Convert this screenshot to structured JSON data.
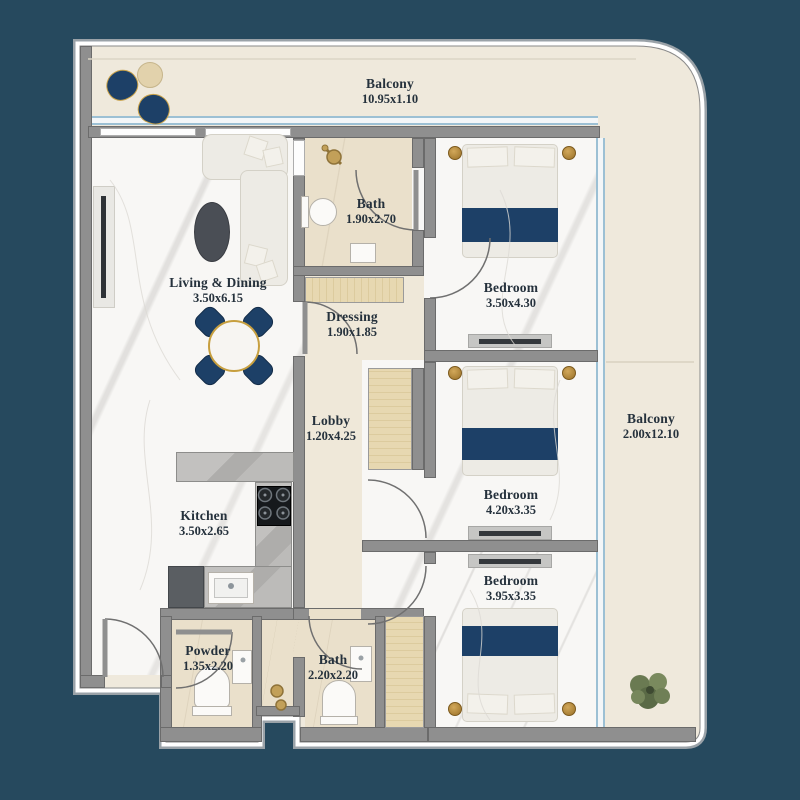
{
  "plan": {
    "title": "Apartment Floor Plan",
    "rooms": [
      {
        "name": "Balcony",
        "dims": "10.95x1.10"
      },
      {
        "name": "Living & Dining",
        "dims": "3.50x6.15"
      },
      {
        "name": "Bath",
        "dims": "1.90x2.70"
      },
      {
        "name": "Bedroom",
        "dims": "3.50x4.30"
      },
      {
        "name": "Dressing",
        "dims": "1.90x1.85"
      },
      {
        "name": "Lobby",
        "dims": "1.20x4.25"
      },
      {
        "name": "Balcony",
        "dims": "2.00x12.10"
      },
      {
        "name": "Bedroom",
        "dims": "4.20x3.35"
      },
      {
        "name": "Kitchen",
        "dims": "3.50x2.65"
      },
      {
        "name": "Bedroom",
        "dims": "3.95x3.35"
      },
      {
        "name": "Powder",
        "dims": "1.35x2.20"
      },
      {
        "name": "Bath",
        "dims": "2.20x2.20"
      }
    ],
    "icons": {
      "bed-icon": "double bed with navy runner",
      "sofa-icon": "L-shaped sofa",
      "dining-table-icon": "round table with 4 navy chairs",
      "coffee-table-icon": "dark oval table",
      "tv-icon": "wall-mounted TV panel",
      "stove-icon": "4-burner hob",
      "sink-icon": "kitchen sink",
      "fridge-icon": "refrigerator",
      "toilet-icon": "WC",
      "basin-icon": "wash basin",
      "shower-icon": "gold shower mixer",
      "wardrobe-icon": "wood wardrobe",
      "plant-icon": "potted plant",
      "balcony-chair-icon": "navy lounge chair",
      "door-icon": "door swing arc"
    }
  },
  "colors": {
    "background": "#26495e",
    "wall": "#8f8f8f",
    "wall_dark": "#6b6b6b",
    "floor_interior": "#f8f7f5",
    "floor_bath": "#eae0cb",
    "floor_hall": "#efe8d9",
    "floor_balcony": "#efe9dc",
    "accent_navy": "#1d4067",
    "gold": "#b5862f",
    "glass": "#9cc0d4",
    "wood": "#e7d8b1",
    "counter": "#b9b8b6",
    "label_ink": "#25313c"
  }
}
